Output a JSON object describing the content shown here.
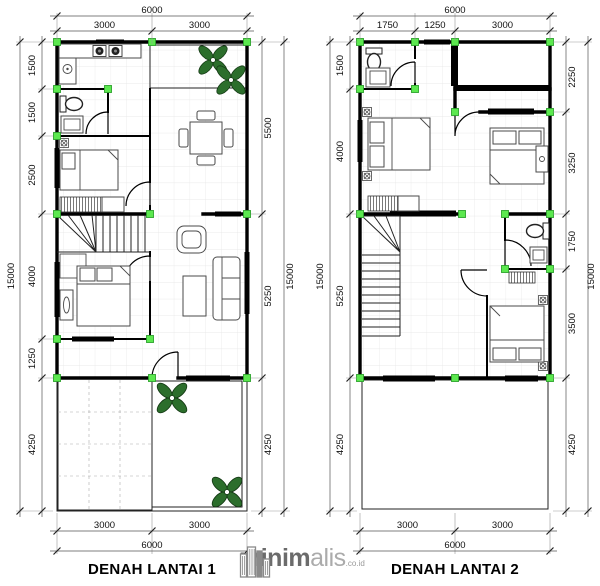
{
  "page": {
    "background": "#ffffff"
  },
  "plans": [
    {
      "title": "DENAH LANTAI 1",
      "dims": {
        "top_total": "6000",
        "top": [
          "3000",
          "3000"
        ],
        "left_total": "15000",
        "left": [
          "1500",
          "1500",
          "2500",
          "4000",
          "1250",
          "4250"
        ],
        "right": [
          "5500",
          "5250",
          "4250"
        ],
        "right_total": "15000",
        "bottom": [
          "3000",
          "3000"
        ],
        "bottom_total": "6000"
      }
    },
    {
      "title": "DENAH LANTAI 2",
      "dims": {
        "top_total": "6000",
        "top": [
          "1750",
          "1250",
          "3000"
        ],
        "left_total": "15000",
        "left": [
          "1500",
          "4000",
          "5250",
          "4250"
        ],
        "right": [
          "2250",
          "3250",
          "1750",
          "3500",
          "4250"
        ],
        "right_total": "15000",
        "bottom": [
          "3000",
          "3000"
        ],
        "bottom_total": "6000"
      }
    }
  ],
  "logo": {
    "brand_bold": "minim",
    "brand_light": "alis",
    "suffix": ".co.id"
  },
  "colors": {
    "wall": "#000000",
    "marker_green": "#5ce84f",
    "garden_dot": "#94c986",
    "carport_gray": "#a9a9a9"
  }
}
